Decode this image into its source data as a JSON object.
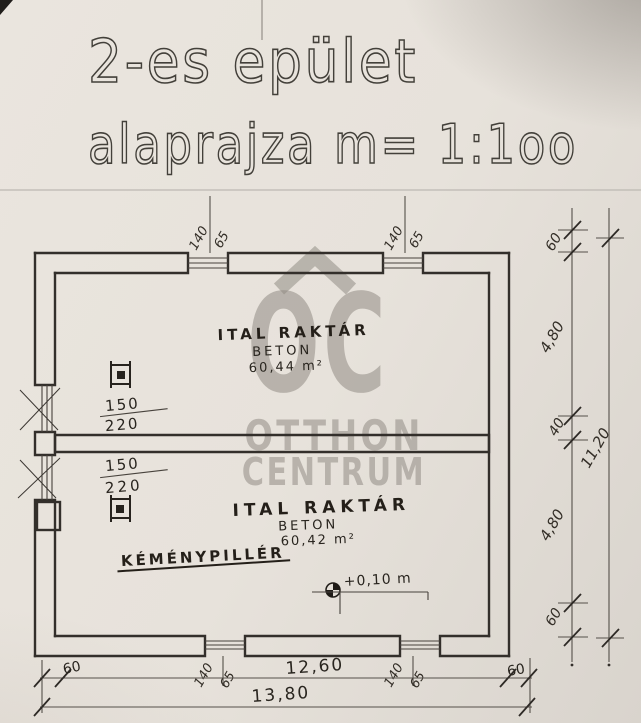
{
  "title": {
    "line1": "2-es epület",
    "line2": "alaprajza m= 1:1oo"
  },
  "watermark": {
    "logo": "OC",
    "name_line1": "OTTHON",
    "name_line2": "CENTRUM"
  },
  "rooms": {
    "room1": {
      "name": "ITAL RAKTÁR",
      "floor": "BETON",
      "area": "60,44 m²"
    },
    "room2": {
      "name": "ITAL RAKTÁR",
      "floor": "BETON",
      "area": "60,42 m²"
    }
  },
  "annotations": {
    "chimney_pillar": "KÉMÉNYPILLÉR",
    "floor_level": "+0,10 m"
  },
  "dimensions": {
    "window_width": "140",
    "window_sill": "65",
    "left_opening_width": "150",
    "left_opening_sill": "220",
    "right_chain": {
      "top_wall": "60",
      "room1_depth": "4,80",
      "mid_wall": "40",
      "room2_depth": "4,80",
      "bottom_wall": "60",
      "total": "11,20"
    },
    "bottom_chain": {
      "left_wall": "60",
      "inner_width": "12,60",
      "right_wall": "60",
      "total": "13,80"
    }
  }
}
